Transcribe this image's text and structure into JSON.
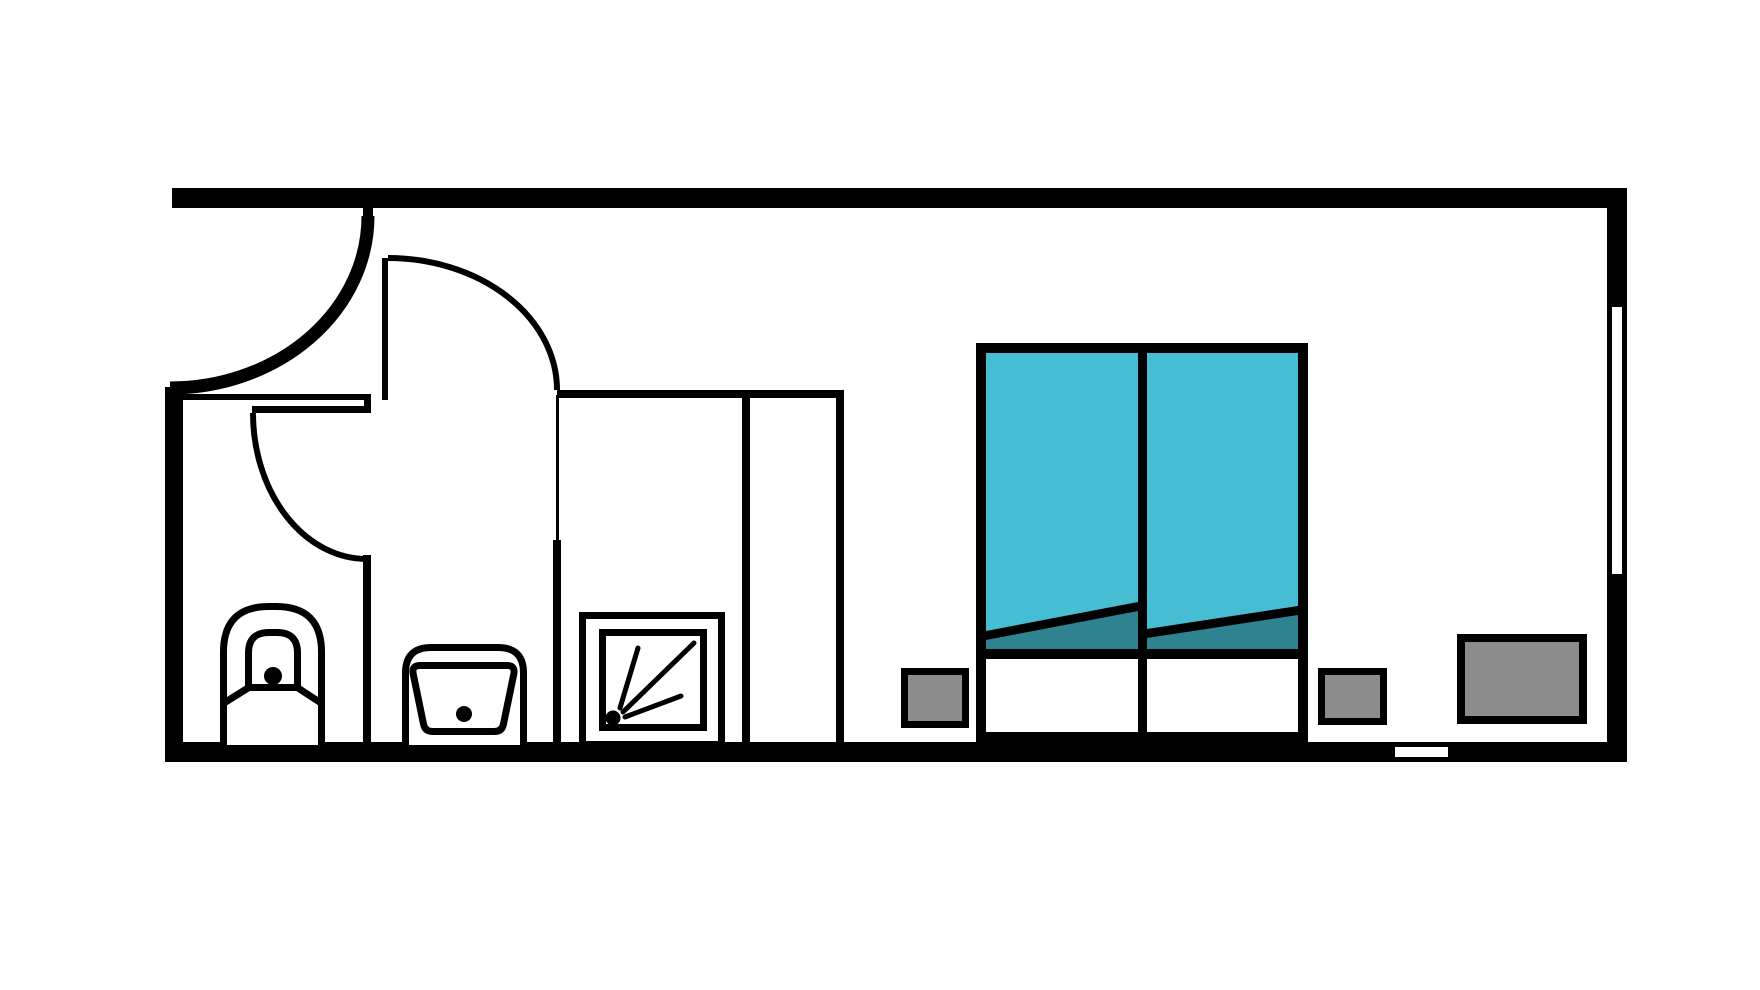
{
  "document": {
    "type": "floor-plan",
    "description": "Single-room apartment / hotel room floor plan, top-down view, black outline style on white background"
  },
  "colors": {
    "background": "#ffffff",
    "wall": "#000000",
    "duvet": "#47bdd4",
    "duvet_fold": "#2f8390",
    "sheet": "#ffffff",
    "furniture": "#8c8c8c"
  },
  "rooms": [
    {
      "name": "bathroom",
      "fixtures": [
        {
          "name": "toilet",
          "style": "outline with bowl and flush dot"
        },
        {
          "name": "sink",
          "style": "outline basin with drain dot"
        },
        {
          "name": "shower",
          "style": "square stall with spray head icon"
        }
      ]
    },
    {
      "name": "bedroom",
      "furniture": [
        {
          "name": "double-bed",
          "parts": [
            "teal duvet left",
            "teal duvet right",
            "folded duvet edge",
            "white sheet foot section"
          ]
        },
        {
          "name": "nightstand-left",
          "fill": "gray"
        },
        {
          "name": "nightstand-right",
          "fill": "gray"
        },
        {
          "name": "dresser",
          "fill": "gray"
        }
      ]
    }
  ],
  "openings": [
    {
      "name": "entry-door",
      "type": "swing door, thick arc, top-left corner"
    },
    {
      "name": "hallway-door",
      "type": "swing door with leaf and arc"
    },
    {
      "name": "bathroom-door",
      "type": "swing door arc into toilet area"
    },
    {
      "name": "window-right-wall",
      "type": "white slot in right wall"
    },
    {
      "name": "threshold-bottom-wall",
      "type": "small white slot in bottom wall"
    }
  ]
}
